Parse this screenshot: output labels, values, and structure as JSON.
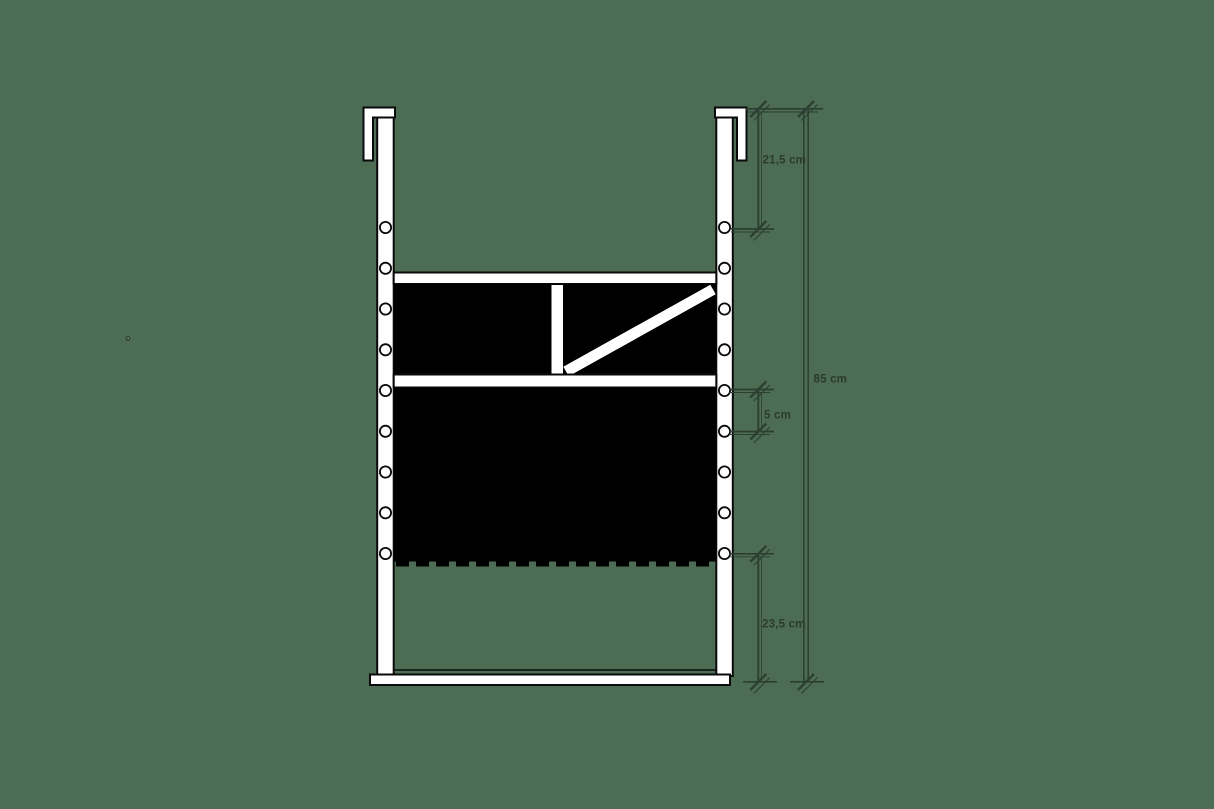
{
  "canvas": {
    "width": 1214,
    "height": 809,
    "background": "#4d6c54"
  },
  "drawing": {
    "subject": "frame-elevation-technical-drawing",
    "colors": {
      "outline": "#0a0a0a",
      "fill": "#ffffff",
      "panel": "#000000",
      "dimension_line": "#2c3e30",
      "dimension_text": "#2b3b2e",
      "background": "#4d6c54"
    }
  },
  "dimensions": [
    {
      "id": "hook-to-first-hole",
      "label": "21,5 cm"
    },
    {
      "id": "overall-height",
      "label": "85 cm"
    },
    {
      "id": "rail-gap",
      "label": "5 cm"
    },
    {
      "id": "panel-to-base",
      "label": "23,5 cm"
    }
  ]
}
